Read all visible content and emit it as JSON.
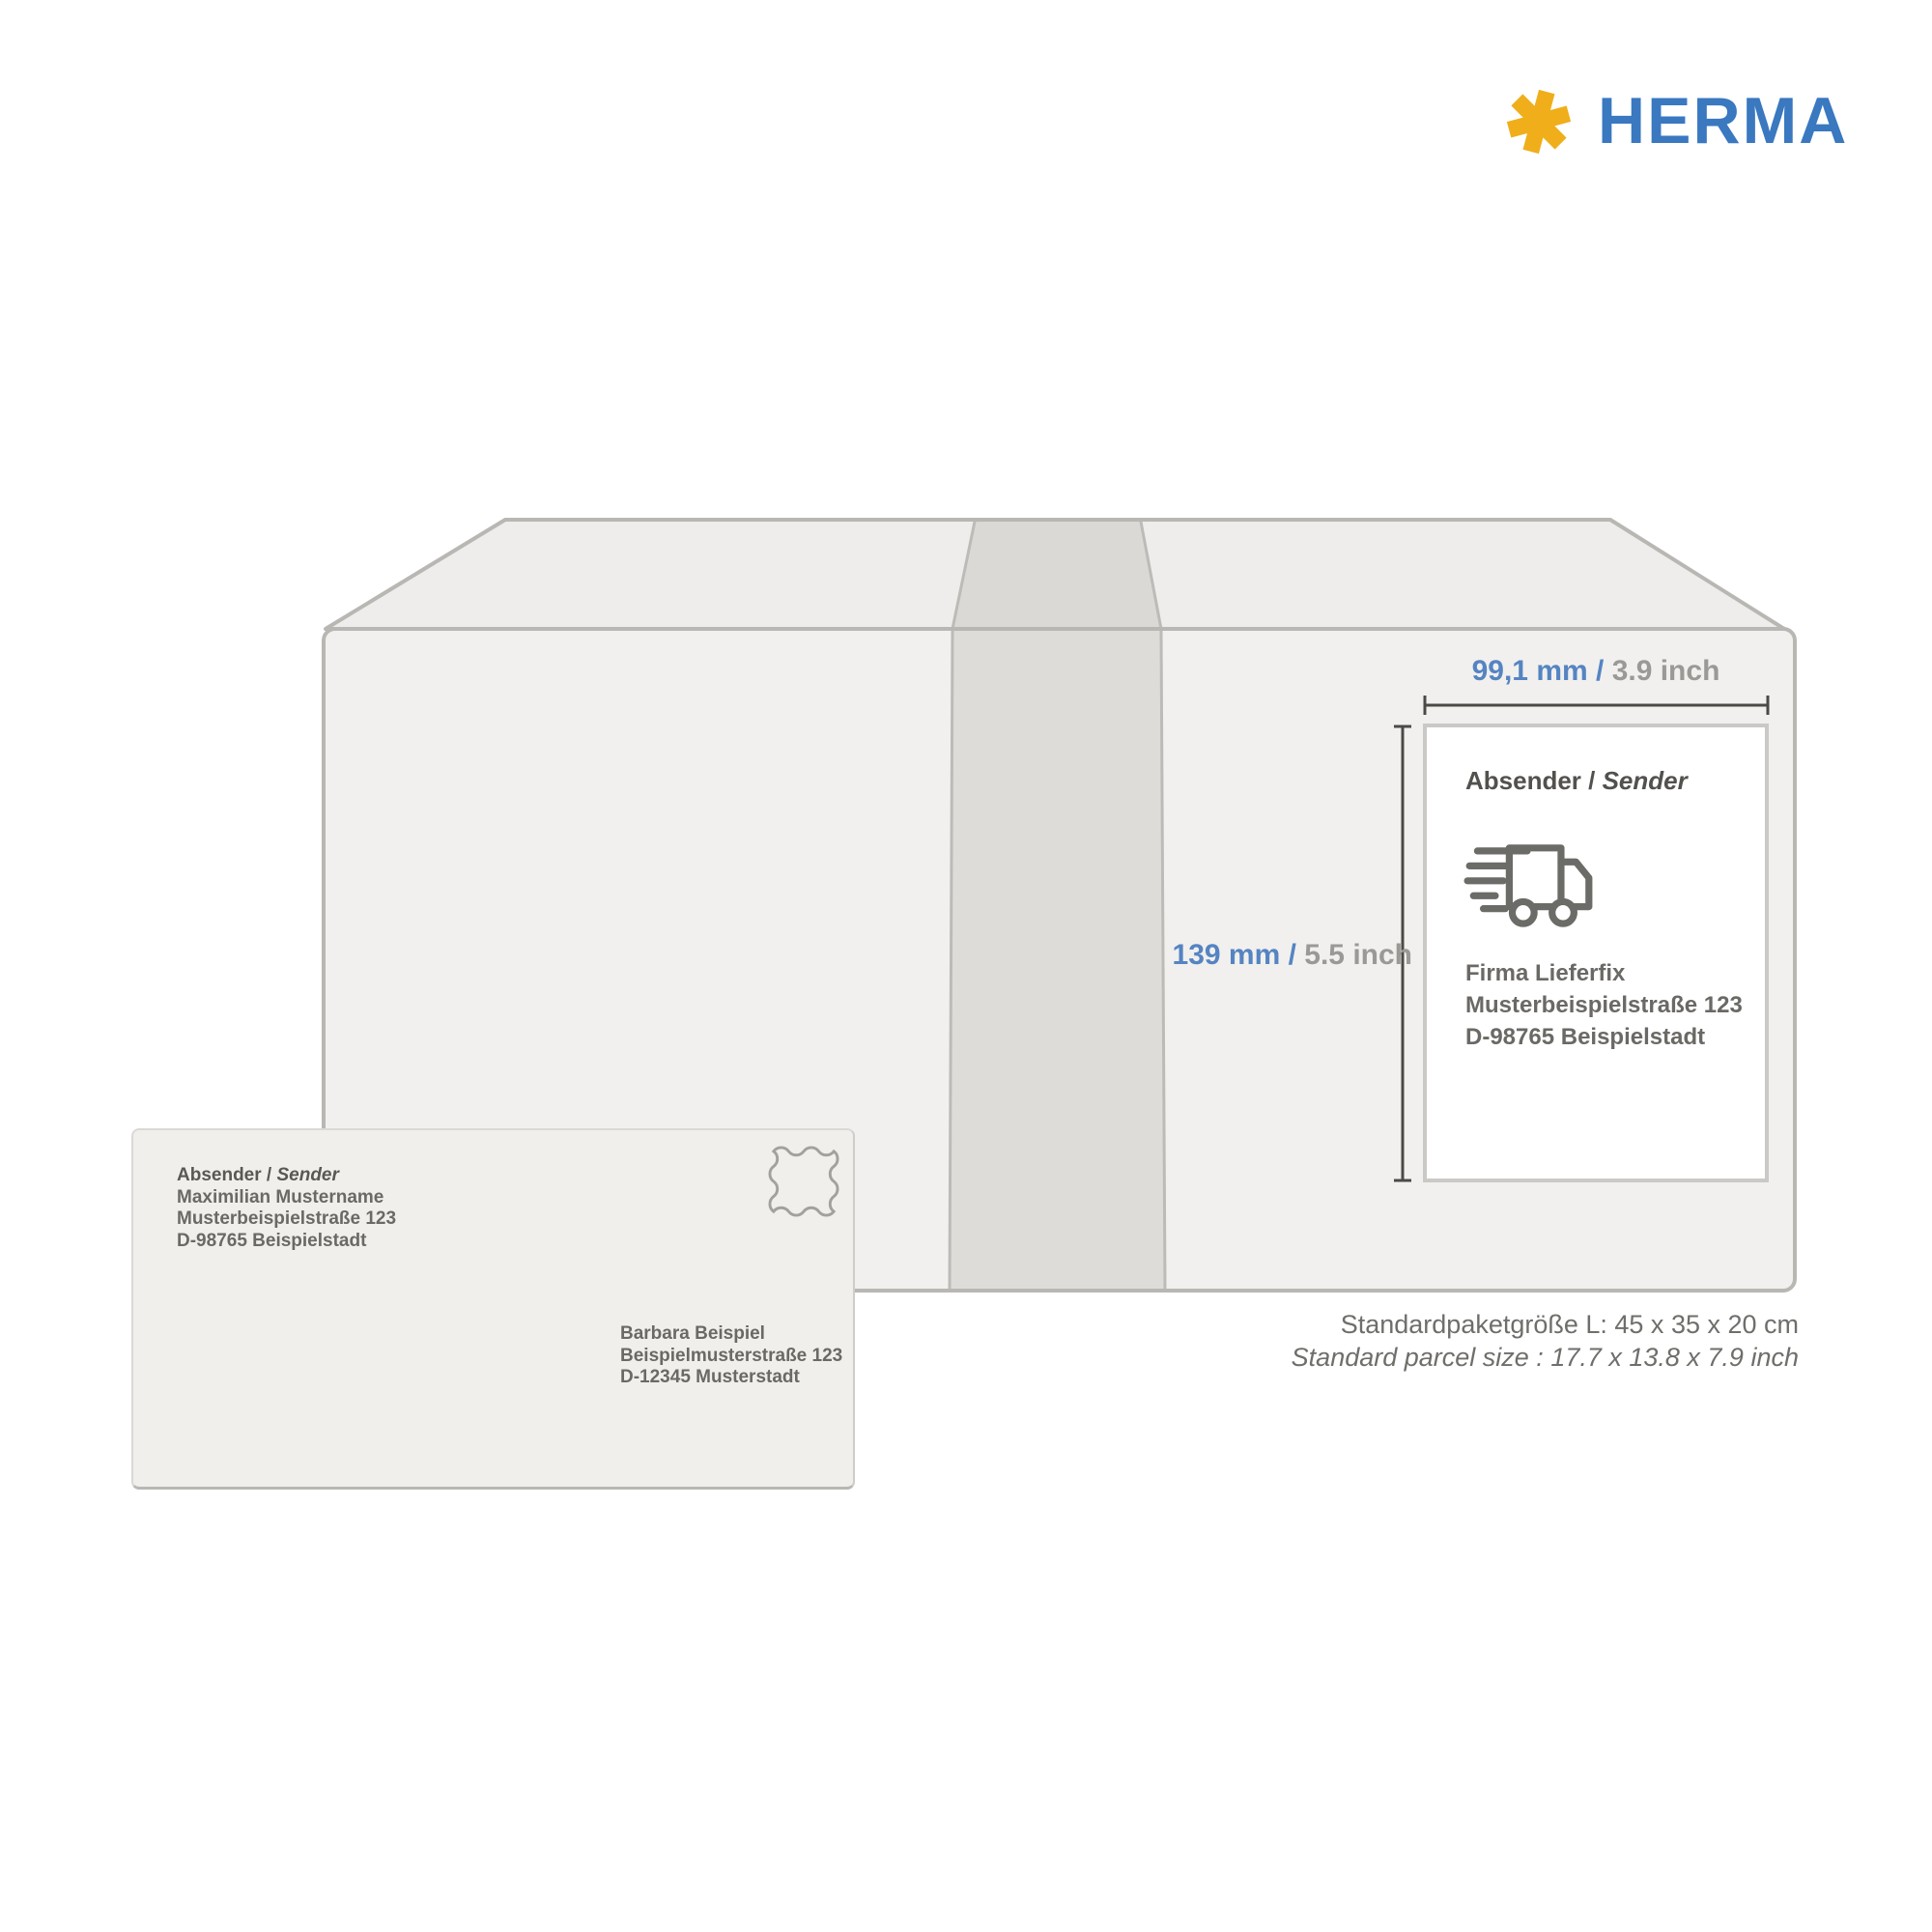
{
  "brand": {
    "name": "HERMA",
    "logo_icon": "asterisk",
    "blue": "#3a78c0",
    "yellow": "#f0ae1b"
  },
  "dimensions": {
    "width": {
      "metric": "99,1 mm",
      "slash": " / ",
      "imperial": "3.9 inch"
    },
    "height": {
      "metric": "139 mm",
      "slash": " / ",
      "imperial": "5.5 inch"
    },
    "metric_color": "#5584c2",
    "imperial_color": "#9a9996"
  },
  "shipping_label": {
    "header_de": "Absender",
    "header_sep": " / ",
    "header_en": "Sender",
    "icon": "delivery-truck-icon",
    "address_lines": [
      "Firma Lieferfix",
      "Musterbeispielstraße 123",
      "D-98765 Beispielstadt"
    ]
  },
  "envelope": {
    "sender_header_de": "Absender",
    "sender_header_sep": " / ",
    "sender_header_en": "Sender",
    "sender_lines": [
      "Maximilian Mustername",
      "Musterbeispielstraße 123",
      "D-98765 Beispielstadt"
    ],
    "recipient_lines": [
      "Barbara Beispiel",
      "Beispielmusterstraße 123",
      "D-12345 Musterstadt"
    ],
    "stamp": "stamp-outline-icon"
  },
  "caption": {
    "line_de": "Standardpaketgröße L: 45 x 35 x 20 cm",
    "line_en": "Standard parcel size : 17.7 x 13.8 x 7.9 inch"
  }
}
